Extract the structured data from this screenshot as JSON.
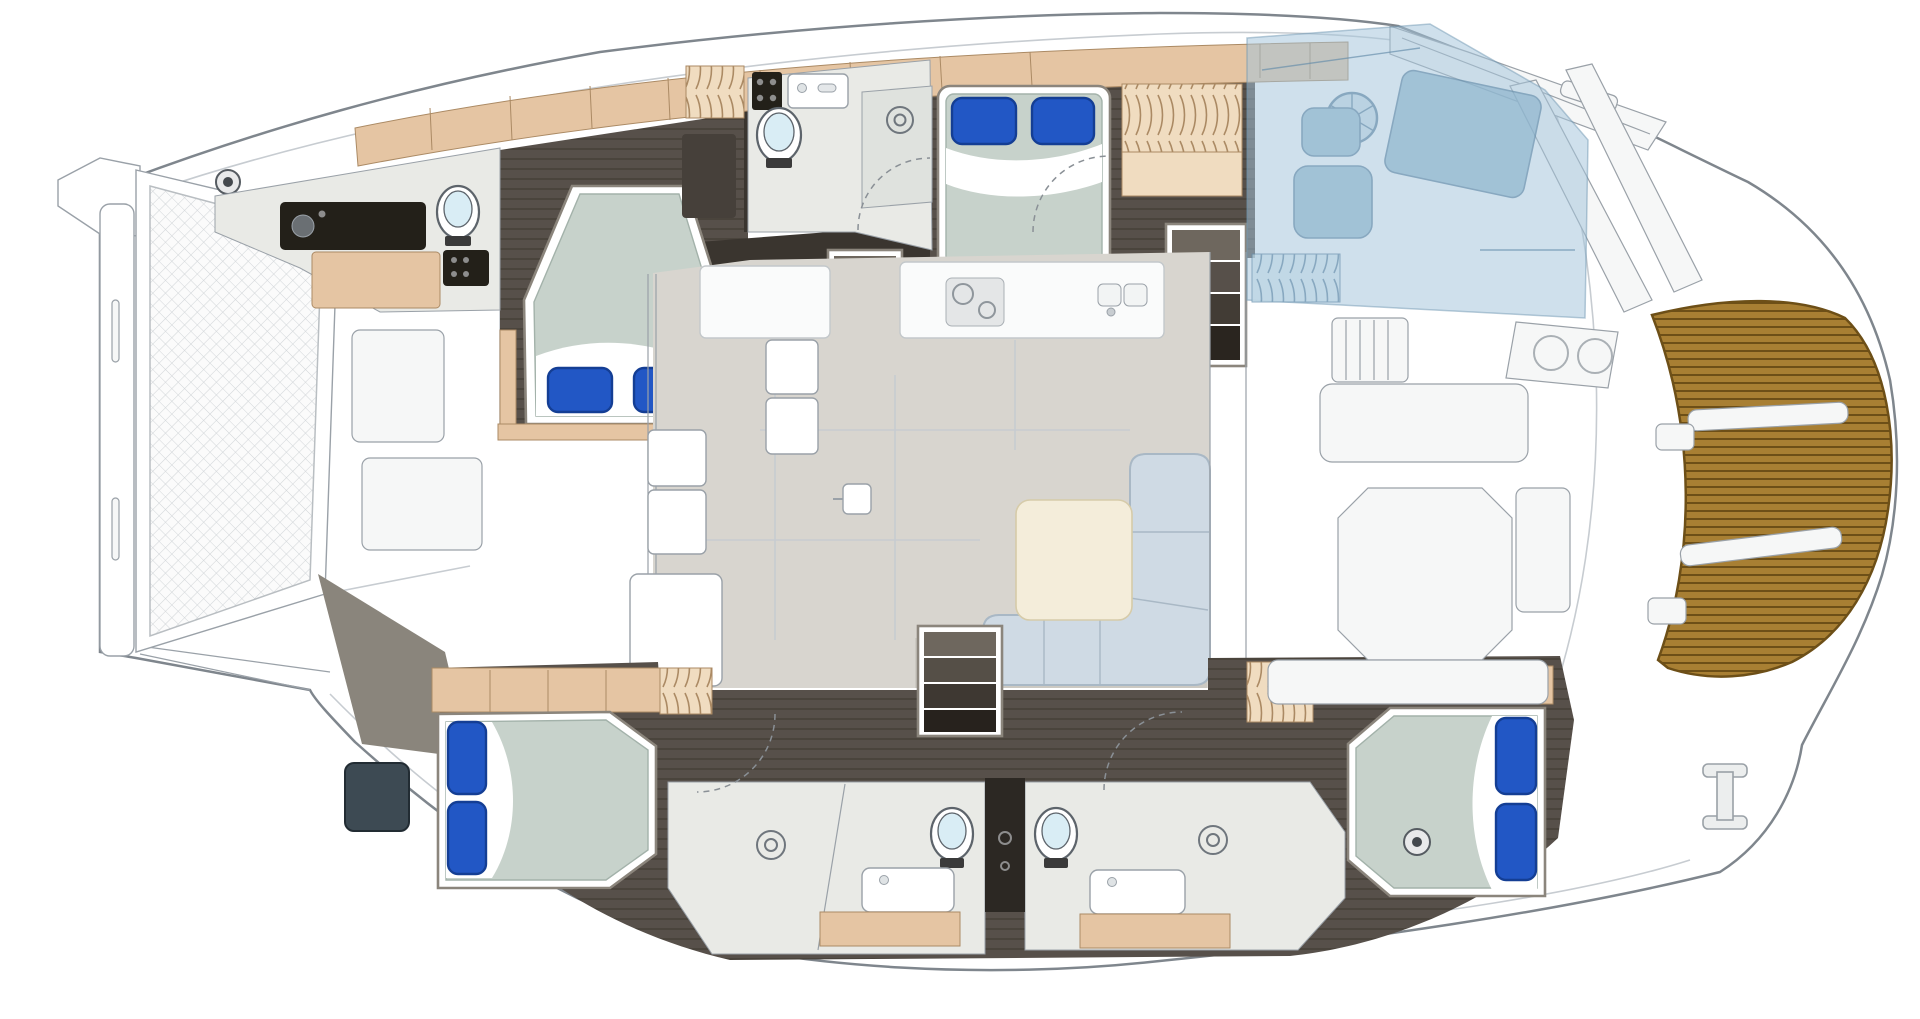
{
  "meta": {
    "subject": "Catamaran yacht interior deck floor plan, top-down view, bow facing left",
    "canvas": {
      "width": 1920,
      "height": 1019
    }
  },
  "colors": {
    "hull": "#ffffff",
    "hullStroke": "#7f868d",
    "seam": "#c7ccd1",
    "fixStroke": "#9aa1a8",
    "frameStroke": "#8b857c",
    "darkFloor": "#57504a",
    "darkFloorLine": "#453f38",
    "wallDark": "#3a352f",
    "wood": "#e5c5a3",
    "woodLight": "#f0dcc0",
    "woodStroke": "#ab8a64",
    "floorLight": "#e9eae6",
    "shower": "#dfe2de",
    "salonFloor": "#d8d5cf",
    "salonFloorDark": "#ccc9c2",
    "counter": "#fafbfb",
    "mattress": "#c7d2cb",
    "mattressLine": "#a3b2aa",
    "sheet": "#ffffff",
    "pillow": "#2257c5",
    "pillowDark": "#143e94",
    "toiletLid": "#d9edf5",
    "appliance": "#232019",
    "sofa": "#cfdae4",
    "sofaStroke": "#a9b8c5",
    "table": "#f4edda",
    "overlay": "#a3c4da",
    "overlayFurn": "#8fb6ce",
    "overlayStroke": "#6e95b1",
    "teak": "#a87f33",
    "teakLine": "#6d4f17",
    "divider": "#2c2823",
    "window": "#3d4a53",
    "tramp": "#d2d6d9"
  },
  "features": {
    "bow": {
      "trampoline": "netted trampoline between bows",
      "crossbeam": "forward crossbeam",
      "bowsprit": "bowsprit fitting",
      "windlass": "deck windlass fitting"
    },
    "cabins": [
      {
        "id": "forward-port-cabin",
        "bed": "island berth, head aft, 2 blue pillows"
      },
      {
        "id": "port-aft-cabin",
        "bed": "double berth, head forward, 2 blue pillows"
      },
      {
        "id": "starboard-forward-cabin",
        "bed": "double berth, head forward, 2 blue pillows"
      },
      {
        "id": "starboard-aft-cabin",
        "bed": "double berth, head aft, 2 blue pillows"
      }
    ],
    "heads": [
      {
        "id": "forward-port-head",
        "fixtures": [
          "toilet",
          "sink-counter",
          "wood-vanity",
          "appliance"
        ]
      },
      {
        "id": "port-shower-room",
        "fixtures": [
          "toilet",
          "sink",
          "shower-drain",
          "appliance"
        ]
      },
      {
        "id": "starboard-forward-head",
        "fixtures": [
          "toilet",
          "sink",
          "shower-drain"
        ]
      },
      {
        "id": "starboard-aft-head",
        "fixtures": [
          "toilet",
          "sink",
          "shower-drain"
        ]
      }
    ],
    "salon": {
      "sofa": "L-shaped settee",
      "table": "salon table",
      "galley": [
        "counter",
        "cooktop",
        "double-sink",
        "fridge-units"
      ]
    },
    "stairs": [
      "port-hull-companionway",
      "starboard-forward-companionway",
      "starboard-aft-companionway"
    ],
    "cockpit": {
      "furniture": [
        "slatted-bench",
        "bench-seat",
        "cockpit-table",
        "sun-pad",
        "transom-seat"
      ],
      "vents": "twin round deck vents"
    },
    "helm_overlay": {
      "type": "semi-transparent flybridge helm station",
      "items": [
        "steering-wheel",
        "helm-console",
        "helm-seat",
        "slatted-bench"
      ]
    },
    "stern": {
      "platform": "teak swim platform with steps",
      "cleat": "mooring cleat",
      "davits": "twin transom supports"
    },
    "lockers": [
      "coil-front-locker-port",
      "hanging-locker-port-aft",
      "coil-locker-starboard-forward",
      "coil-locker-starboard-aft"
    ]
  }
}
